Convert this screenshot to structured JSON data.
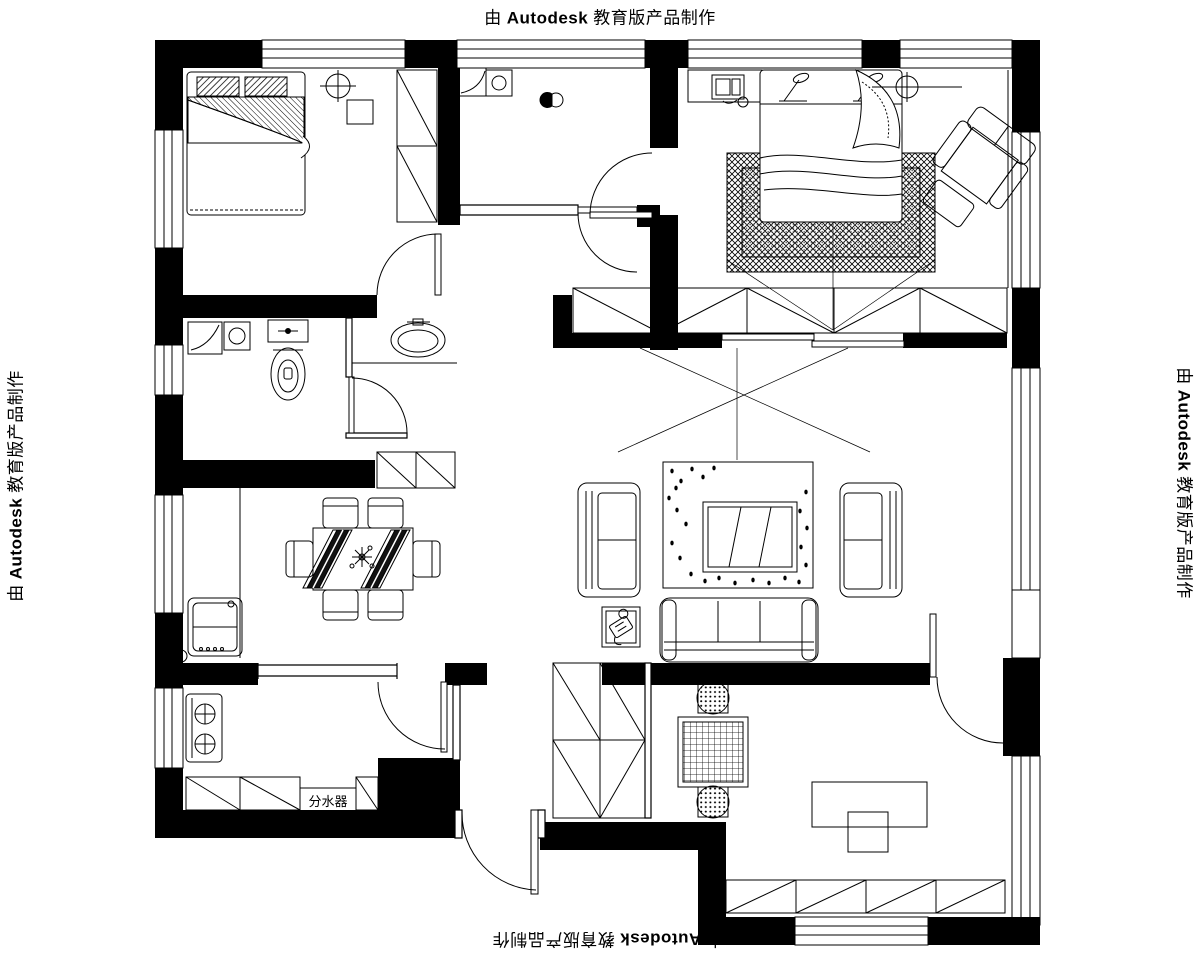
{
  "watermark": {
    "prefix": "由",
    "brand": "Autodesk",
    "suffix": "教育版产品制作"
  },
  "labels": {
    "manifold": "分水器"
  },
  "colors": {
    "ink": "#000000",
    "background": "#ffffff"
  }
}
